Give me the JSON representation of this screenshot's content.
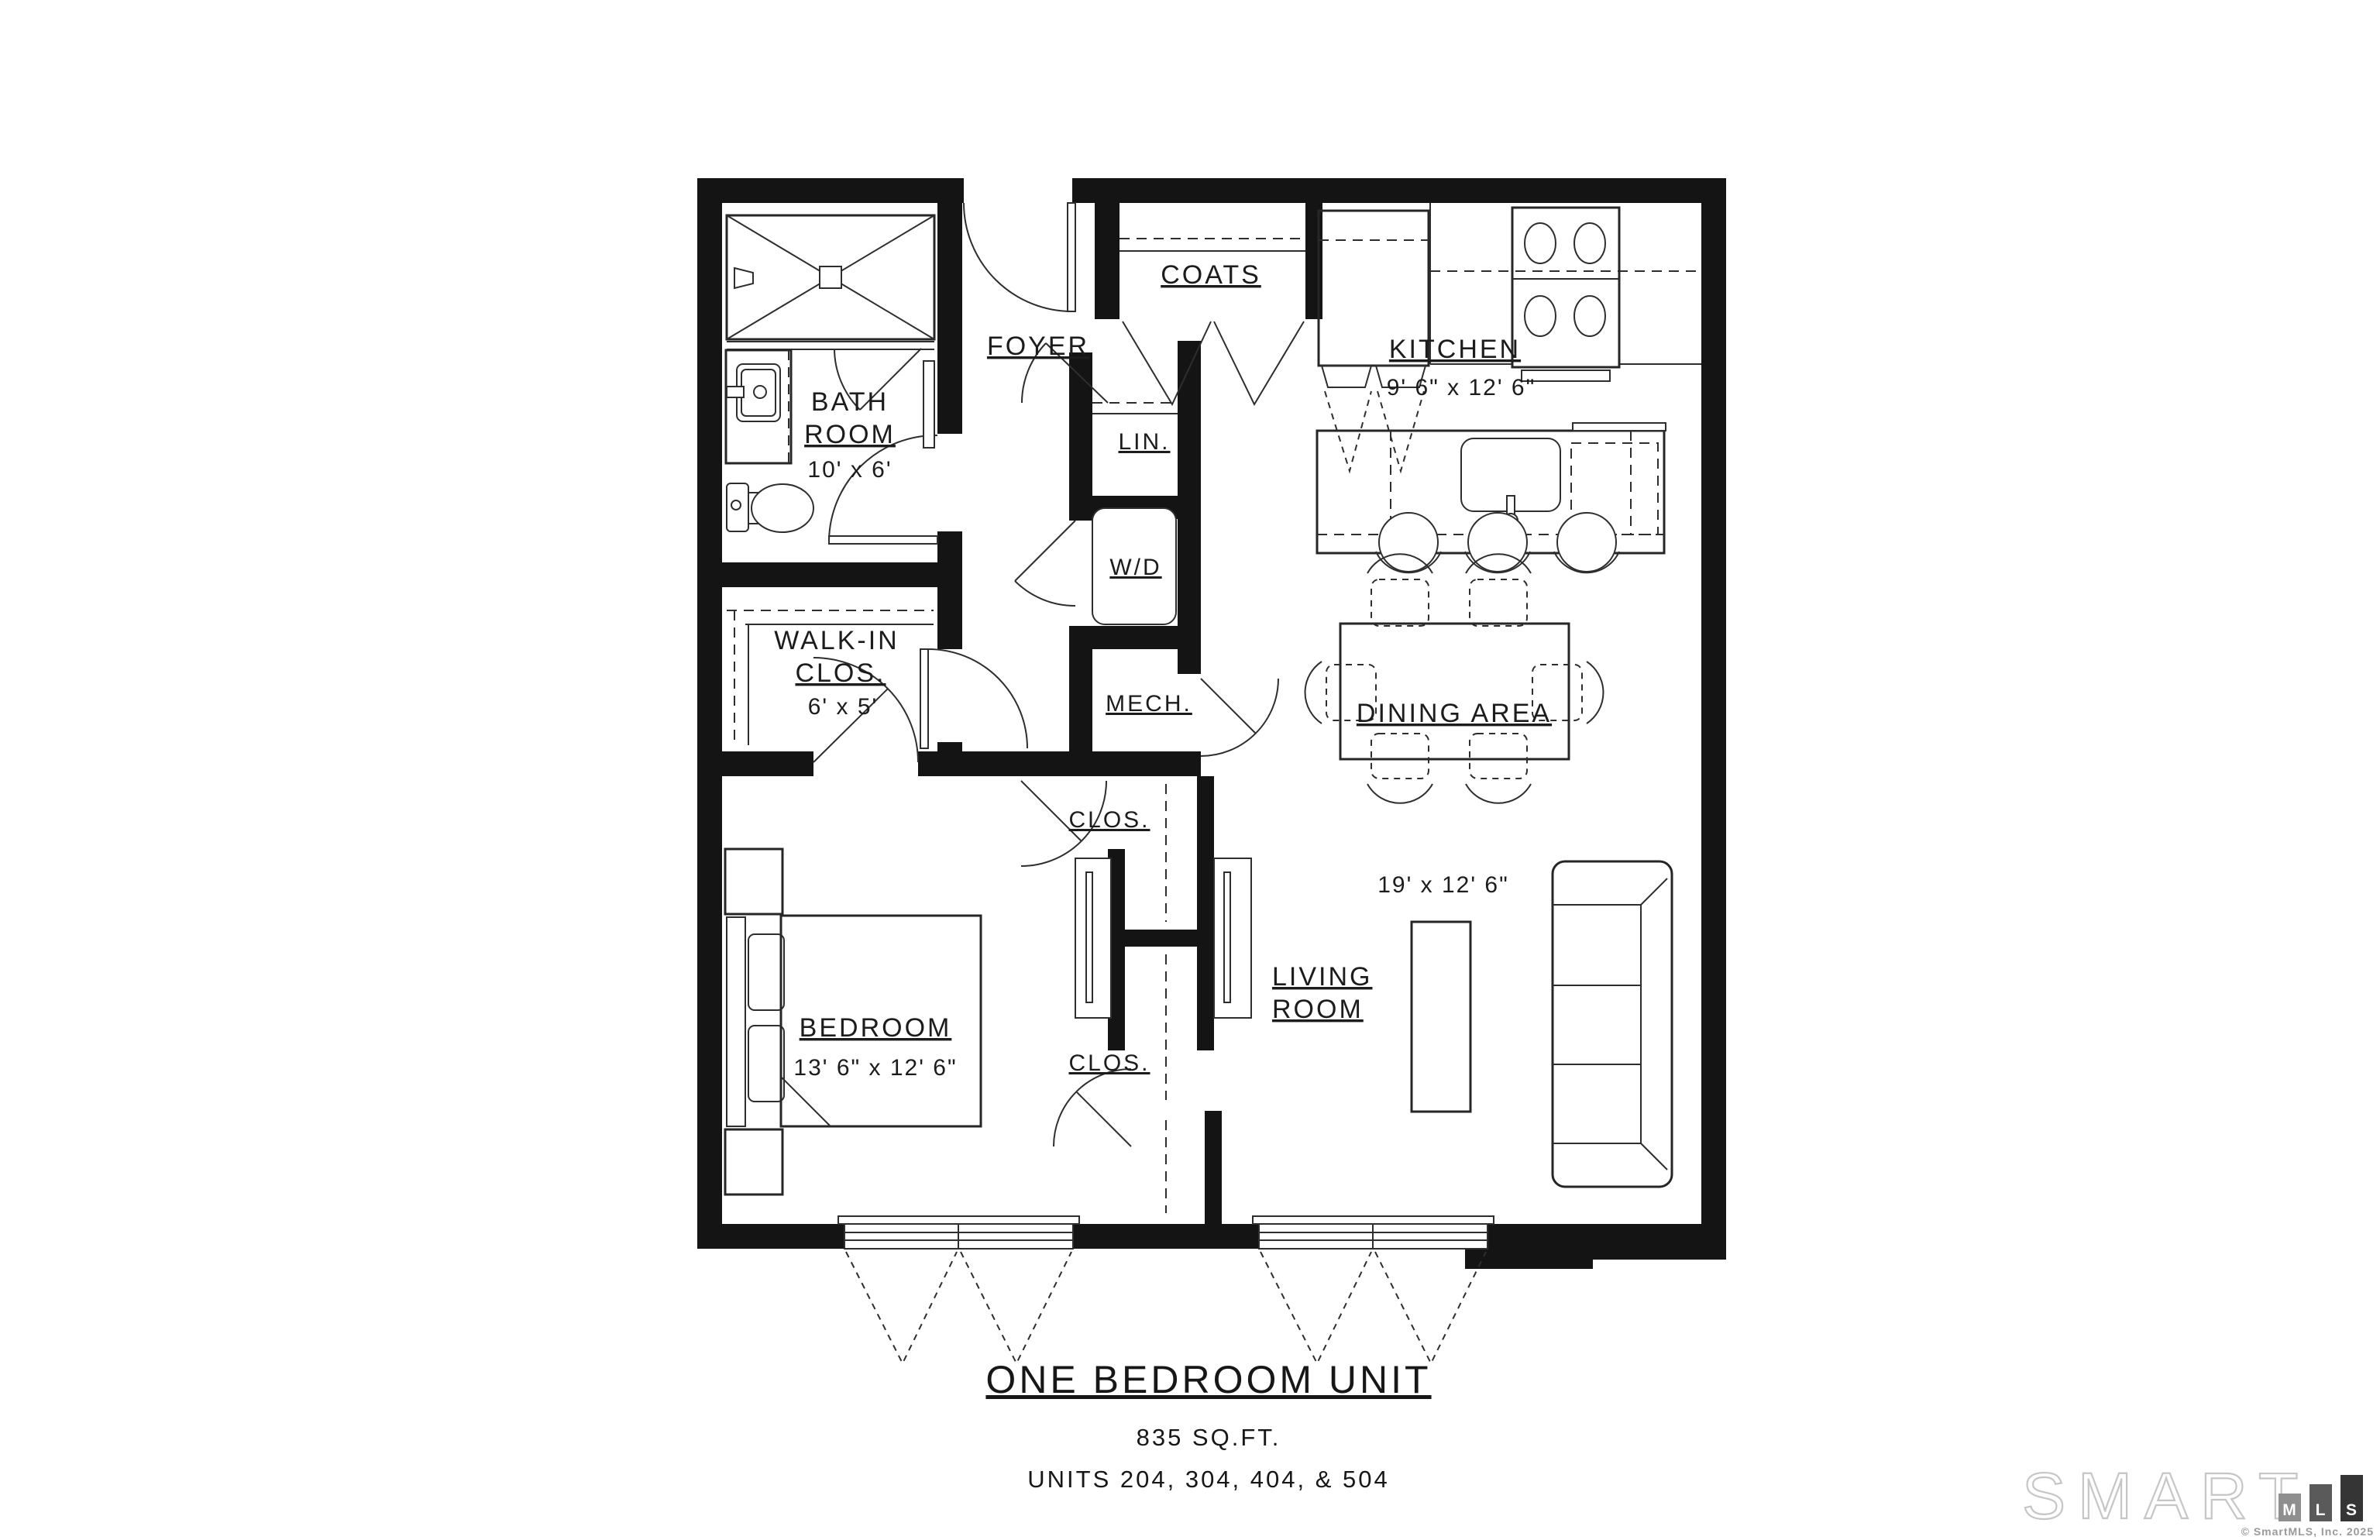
{
  "rooms": {
    "foyer": {
      "label": "FOYER"
    },
    "coats": {
      "label": "COATS"
    },
    "kitchen": {
      "label": "KITCHEN",
      "dims": "9' 6\" x 12' 6\""
    },
    "bath": {
      "line1": "BATH",
      "line2": "ROOM",
      "dims": "10' x 6'"
    },
    "linen": {
      "label": "LIN."
    },
    "washer_dryer": {
      "label": "W/D"
    },
    "mech": {
      "label": "MECH."
    },
    "walkin": {
      "line1": "WALK-IN",
      "line2": "CLOS.",
      "dims": "6' x 5'"
    },
    "dining": {
      "label": "DINING AREA"
    },
    "bedroom": {
      "label": "BEDROOM",
      "dims": "13' 6\" x 12' 6\""
    },
    "closet_upper": {
      "label": "CLOS."
    },
    "closet_lower": {
      "label": "CLOS."
    },
    "living": {
      "line1": "LIVING",
      "line2": "ROOM",
      "dims": "19' x 12' 6\""
    }
  },
  "title_block": {
    "title": "ONE BEDROOM UNIT",
    "sqft": "835 SQ.FT.",
    "units": "UNITS 204, 304, 404, & 504"
  },
  "watermark": {
    "brand": "SMART",
    "m": "M",
    "l": "L",
    "s": "S",
    "copyright": "© SmartMLS, Inc. 2025"
  },
  "colors": {
    "wall": "#141414",
    "line": "#262626",
    "watermark_outline": "#c6c6c6",
    "mls_m_box": "#8f8f8f",
    "mls_l_box": "#5a5a5a",
    "mls_s_box": "#353535"
  }
}
